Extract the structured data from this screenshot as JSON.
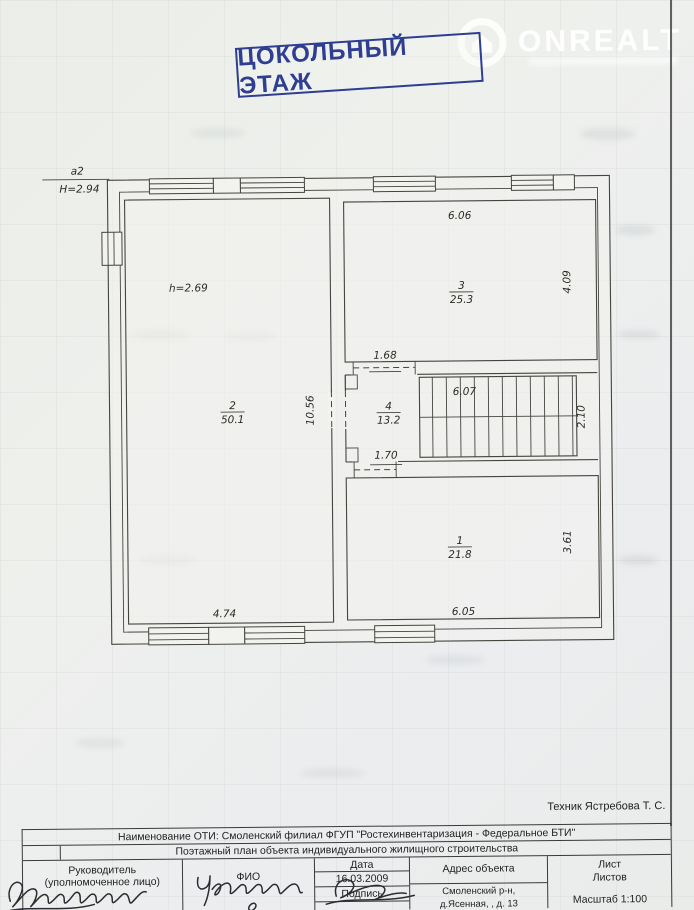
{
  "watermark": {
    "brand": "ONREALT"
  },
  "stamp": {
    "title": "ЦОКОЛЬНЫЙ ЭТАЖ"
  },
  "plan": {
    "exterior": {
      "axis_label": "а2",
      "height": "Н=2.94"
    },
    "rooms": {
      "r1": {
        "num": "1",
        "area": "21.8"
      },
      "r2": {
        "num": "2",
        "area": "50.1",
        "ceiling": "h=2.69"
      },
      "r3": {
        "num": "3",
        "area": "25.3"
      },
      "r4": {
        "num": "4",
        "area": "13.2"
      }
    },
    "dims": {
      "d606": "6.06",
      "d409": "4.09",
      "d168": "1.68",
      "d607": "6.07",
      "d210": "2.10",
      "d1056": "10.56",
      "d170": "1.70",
      "d361": "3.61",
      "d605": "6.05",
      "d474": "4.74"
    }
  },
  "footer": {
    "technician": "Техник  Ястребова Т. С.",
    "org_row": "Наименование ОТИ: Смоленский филиал ФГУП \"Ростехинвентаризация  - Федеральное БТИ\"",
    "doc_row": "Поэтажный план объекта индивидуального жилищного строительства",
    "head_label": "Руководитель",
    "head_sub": "(уполномоченное лицо)",
    "fio_label": "ФИО",
    "date_label": "Дата",
    "date_value": "16.03.2009",
    "sign_label": "Подпись",
    "address_label": "Адрес объекта",
    "address_line1": "Смоленский р-н,",
    "address_line2": "д.Ясенная, , д. 13",
    "sheet_label": "Лист",
    "sheets_label": "Листов",
    "scale": "Масштаб 1:100"
  }
}
